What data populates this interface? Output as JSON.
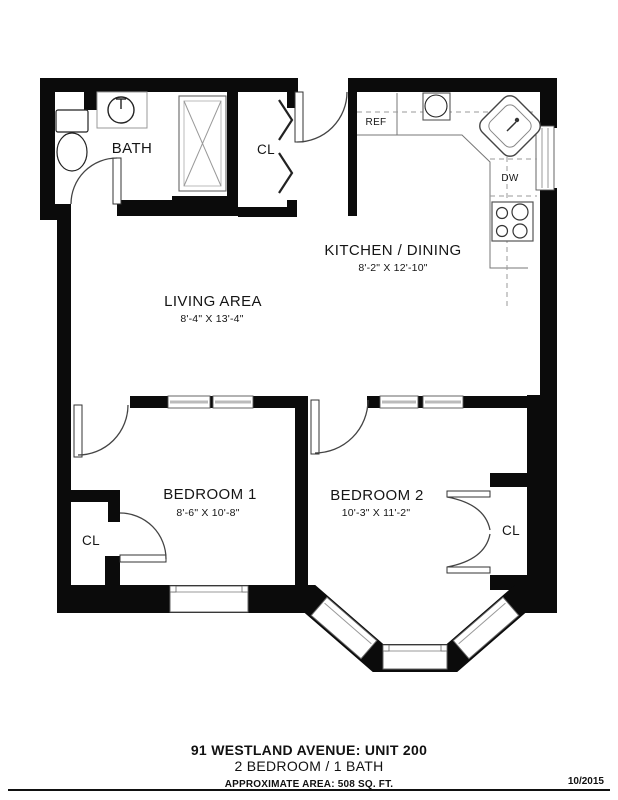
{
  "plan": {
    "labels": {
      "bath": "BATH",
      "hall_closet": "CL",
      "refrigerator": "REF",
      "dishwasher": "DW",
      "kitchen": {
        "name": "KITCHEN / DINING",
        "dims": "8'-2\" X 12'-10\""
      },
      "living": {
        "name": "LIVING AREA",
        "dims": "8'-4\" X 13'-4\""
      },
      "bedroom1": {
        "name": "BEDROOM 1",
        "dims": "8'-6\" X 10'-8\""
      },
      "bedroom2": {
        "name": "BEDROOM 2",
        "dims": "10'-3\" X 11'-2\""
      },
      "bedroom1_closet": "CL",
      "bedroom2_closet": "CL"
    }
  },
  "footer": {
    "address": "91 WESTLAND AVENUE: UNIT 200",
    "unit_type": "2 BEDROOM / 1 BATH",
    "area": "APPROXIMATE AREA:  508 SQ. FT.",
    "date": "10/2015"
  },
  "colors": {
    "wall": "#0b0b0b",
    "line": "#555555",
    "background": "#ffffff"
  }
}
